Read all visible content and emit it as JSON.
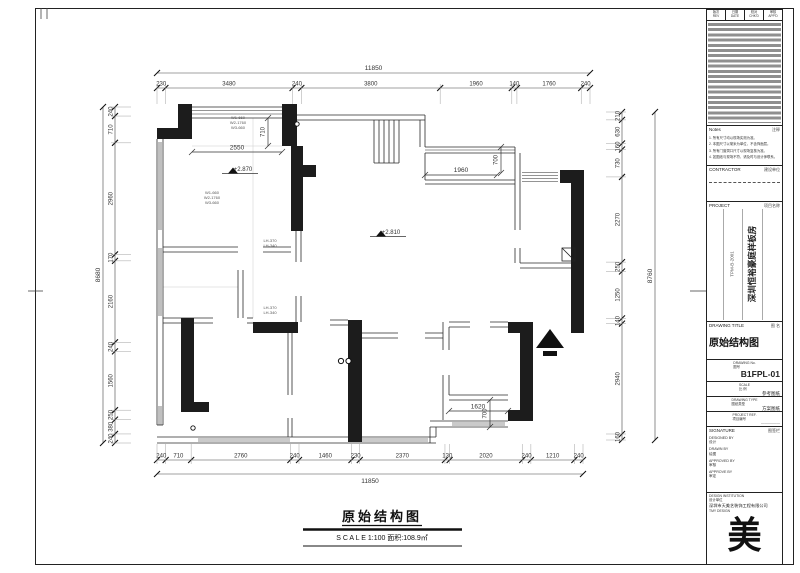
{
  "sheet": {
    "bottom_title": "原始结构图",
    "bottom_scale": "S C A L E   1:100   面积:108.9㎡"
  },
  "plan": {
    "dims": {
      "top_total": "11850",
      "top_chain": [
        "230",
        "3480",
        "240",
        "3800",
        "1960",
        "140",
        "1760",
        "240"
      ],
      "bottom_total": "11850",
      "bottom_chain": [
        "240",
        "710",
        "2760",
        "240",
        "1460",
        "230",
        "2370",
        "130",
        "2020",
        "240",
        "1210",
        "240"
      ],
      "left_total": "8680",
      "left_chain": [
        "240",
        "710",
        "2960",
        "170",
        "2160",
        "240",
        "1560",
        "250",
        "380",
        "240"
      ],
      "right_total": "8760",
      "right_chain": [
        "210",
        "630",
        "160",
        "730",
        "2270",
        "250",
        "1250",
        "140",
        "2940",
        "160"
      ]
    },
    "inner_dims": {
      "bay_width": "2550",
      "bay_depth": "710",
      "balcony_width": "1960",
      "balcony_depth": "700",
      "entry_width": "1620",
      "entry_depth": "700"
    },
    "levels": {
      "living": "+2.870",
      "hall": "+2.810"
    },
    "window_tags": {
      "ws_line1": "W1-660",
      "ws_line2": "W2-1760",
      "ws_line3": "W3-660",
      "lh_line1": "LH-370",
      "lh_line2": "LH-340"
    }
  },
  "titleblock": {
    "rev_headers": [
      {
        "zh": "版次",
        "en": "REV"
      },
      {
        "zh": "日期",
        "en": "DATE"
      },
      {
        "zh": "校对",
        "en": "CHK'D"
      },
      {
        "zh": "审核",
        "en": "APP'D"
      }
    ],
    "notes": {
      "en": "Notes",
      "zh": "注释",
      "items": [
        "1. 所有尺寸均以现场实测为准。",
        "2. 本图尺寸以毫米为单位，不含饰面层。",
        "3. 所有门窗洞口尺寸以现场复核为准。",
        "4. 如图纸与现场不符，请及时与设计师联系。"
      ]
    },
    "contractor": {
      "en": "CONTRACTOR",
      "zh": "建设单位"
    },
    "project": {
      "en": "PROJECT",
      "zh": "项目名称",
      "name_vertical": "深圳恒裕豪庭样板房",
      "code_vertical": "TPM-B-2001"
    },
    "drawing_title": {
      "en": "DRAWING TITLE",
      "zh": "图 名",
      "value": "原始结构图"
    },
    "drawing_no": {
      "en": "DRAWING No.",
      "zh": "图号",
      "value": "B1FPL-01"
    },
    "scale": {
      "en": "SCALE",
      "zh": "比 例",
      "value": "参考图纸"
    },
    "drawing_type": {
      "en": "DRAWING TYPE",
      "zh": "图纸类型",
      "value": "方案图纸"
    },
    "project_ref": {
      "en": "PROJECT REF.",
      "zh": "项目编号",
      "value": "—————"
    },
    "signature": {
      "en": "SIGNATURE",
      "zh": "图签栏"
    },
    "sign_rows": [
      {
        "en": "DESIGNED BY",
        "zh": "设计"
      },
      {
        "en": "DRAWN BY",
        "zh": "绘图"
      },
      {
        "en": "APPROVED BY",
        "zh": "审核"
      },
      {
        "en": "APPROVE BY",
        "zh": "审定"
      }
    ],
    "institution": {
      "en": "DESIGN INSTITUTION",
      "zh": "设计单位",
      "company": "深圳市天美艺装饰工程有限公司",
      "brand": "TMY DESIGN",
      "logo": "美"
    }
  }
}
